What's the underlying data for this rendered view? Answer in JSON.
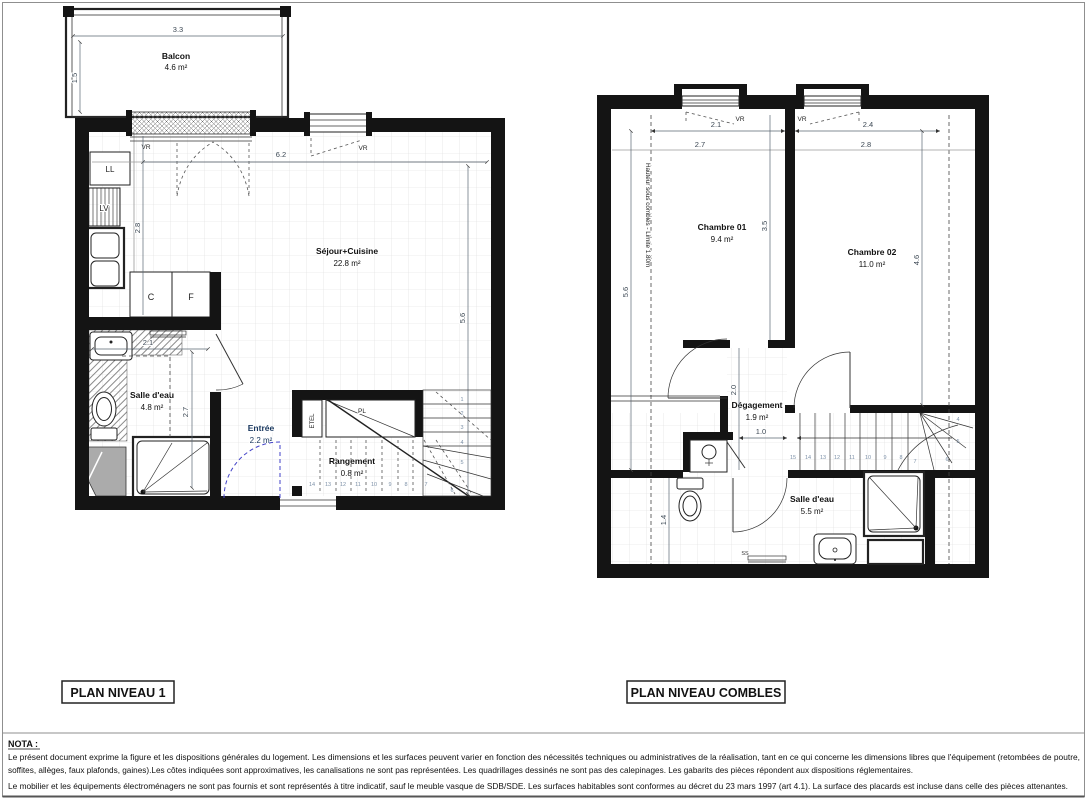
{
  "plan1": {
    "title": "PLAN NIVEAU 1",
    "balcon": {
      "name": "Balcon",
      "area": "4.6 m²"
    },
    "sejour": {
      "name": "Séjour+Cuisine",
      "area": "22.8 m²"
    },
    "salle_eau": {
      "name": "Salle d'eau",
      "area": "4.8 m²"
    },
    "entree": {
      "name": "Entrée",
      "area": "2.2 m²"
    },
    "rangement": {
      "name": "Rangement",
      "area": "0.8 m²"
    },
    "appliances": {
      "ll": "LL",
      "lv": "LV",
      "c": "C",
      "f": "F"
    },
    "closets": {
      "etel": "ETEL",
      "pl": "PL"
    },
    "ss": "SS",
    "vr_window1": "VR",
    "vr_window2": "VR",
    "dims": {
      "balcon_w": "3.3",
      "balcon_h": "1.5",
      "sejour_w": "6.2",
      "sejour_h": "5.6",
      "kitchen_h": "2.8",
      "sde_w": "2.1",
      "sde_h": "2.7"
    },
    "stairs": [
      "1",
      "2",
      "3",
      "4",
      "5",
      "6",
      "7",
      "8",
      "9",
      "10",
      "11",
      "12",
      "13",
      "14"
    ]
  },
  "plan2": {
    "title": "PLAN NIVEAU COMBLES",
    "chambre1": {
      "name": "Chambre 01",
      "area": "9.4 m²"
    },
    "chambre2": {
      "name": "Chambre 02",
      "area": "11.0 m²"
    },
    "degagement": {
      "name": "Dégagement",
      "area": "1.9 m²"
    },
    "salle_eau": {
      "name": "Salle d'eau",
      "area": "5.5 m²"
    },
    "ss": "SS",
    "vr_window1": "VR",
    "vr_window2": "VR",
    "hauteur_note": "Hauteur sous combles - Limite 1.80m",
    "dims": {
      "ch1_w_top": "2.1",
      "ch2_w_top": "2.4",
      "ch1_w": "2.7",
      "ch2_w": "2.8",
      "left_h": "5.6",
      "ch1_h": "3.5",
      "ch2_h": "4.6",
      "deg_h": "2.0",
      "deg_w": "1.0",
      "wc_h": "1.4"
    },
    "stairs": [
      "4",
      "5",
      "6",
      "7",
      "8",
      "9",
      "10",
      "11",
      "12",
      "13",
      "14",
      "15"
    ]
  },
  "nota": {
    "heading": "NOTA :",
    "line1": "Le présent document exprime la figure et les dispositions générales du logement. Les dimensions et les surfaces peuvent varier en fonction des nécessités techniques ou administratives de la réalisation, tant en ce qui concerne les dimensions libres que l'équipement (retombées de poutre,",
    "line2": "soffites, allèges, faux plafonds, gaines).Les côtes indiquées sont approximatives, les canalisations ne sont pas représentées. Les quadrillages dessinés ne sont pas des calepinages. Les gabarits des pièces répondent aux dispositions réglementaires.",
    "line3": "Le mobilier et les équipements électroménagers ne sont pas fournis et sont représentés à titre indicatif, sauf le meuble vasque de SDB/SDE. Les surfaces habitables sont conformes au décret du 23 mars 1997 (art 4.1). La surface des placards est incluse dans celle des pièces attenantes."
  }
}
